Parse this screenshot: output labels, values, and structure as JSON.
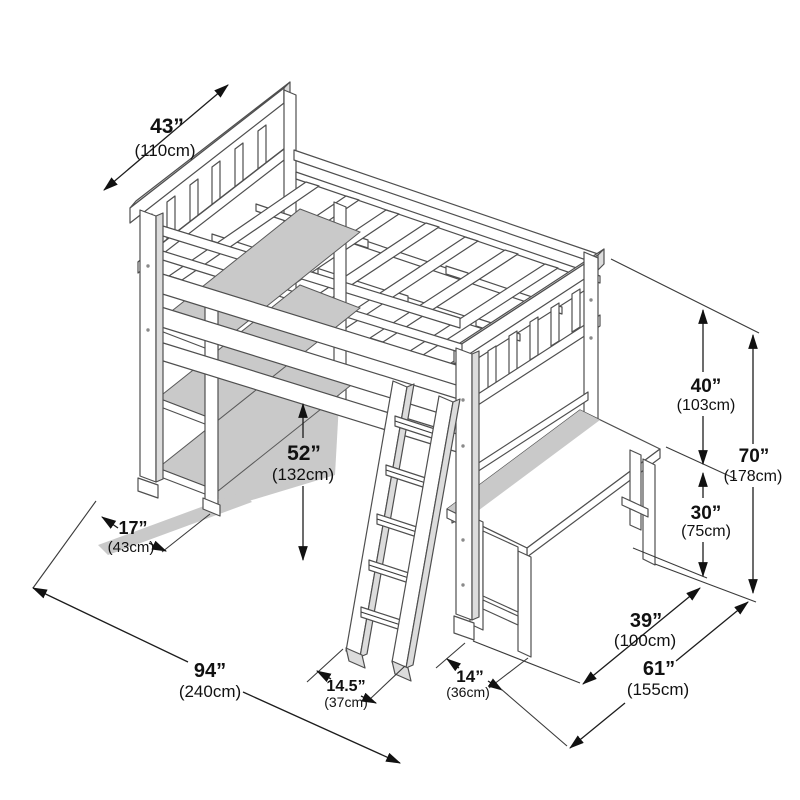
{
  "figure": {
    "type": "isometric dimension diagram",
    "subject": "Loft bed with desk, shelf unit and ladder",
    "background_color": "#ffffff",
    "line_color": "#4f4f4f",
    "dimension_color": "#111111"
  },
  "dimensions": {
    "bed_width": {
      "inches": "43”",
      "metric": "(110cm)"
    },
    "under_bed_clearance": {
      "inches": "52”",
      "metric": "(132cm)"
    },
    "shelf_depth": {
      "inches": "17”",
      "metric": "(43cm)"
    },
    "overall_length": {
      "inches": "94”",
      "metric": "(240cm)"
    },
    "ladder_footprint": {
      "inches": "14.5”",
      "metric": "(37cm)"
    },
    "bed_to_desk_gap": {
      "inches": "14”",
      "metric": "(36cm)"
    },
    "desk_depth": {
      "inches": "39”",
      "metric": "(100cm)"
    },
    "overall_depth": {
      "inches": "61”",
      "metric": "(155cm)"
    },
    "guardrail_to_desk_height": {
      "inches": "40”",
      "metric": "(103cm)"
    },
    "desk_height": {
      "inches": "30”",
      "metric": "(75cm)"
    },
    "overall_height": {
      "inches": "70”",
      "metric": "(178cm)"
    }
  }
}
